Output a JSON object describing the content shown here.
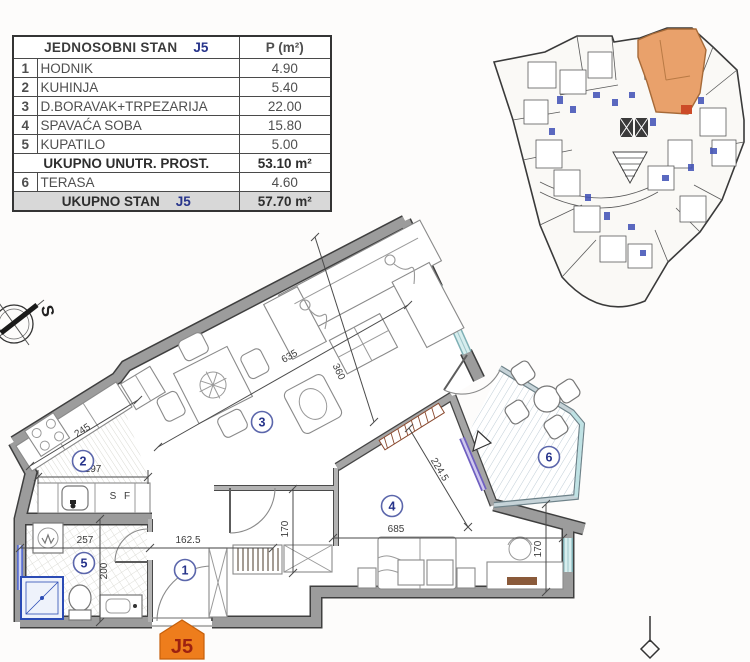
{
  "table": {
    "title": "JEDNOSOBNI STAN",
    "unit_code": "J5",
    "area_header": "P (m²)",
    "rows": [
      {
        "num": "1",
        "name": "HODNIK",
        "area": "4.90"
      },
      {
        "num": "2",
        "name": "KUHINJA",
        "area": "5.40"
      },
      {
        "num": "3",
        "name": "D.BORAVAK+TRPEZARIJA",
        "area": "22.00"
      },
      {
        "num": "4",
        "name": "SPAVAĆA SOBA",
        "area": "15.80"
      },
      {
        "num": "5",
        "name": "KUPATILO",
        "area": "5.00"
      }
    ],
    "subtotal": {
      "label": "UKUPNO UNUTR. PROST.",
      "value": "53.10",
      "unit": "m²"
    },
    "terrace_row": {
      "num": "6",
      "name": "TERASA",
      "area": "4.60"
    },
    "total": {
      "label": "UKUPNO STAN",
      "code": "J5",
      "value": "57.70",
      "unit": "m²"
    }
  },
  "plan": {
    "rooms": {
      "r1": "1",
      "r2": "2",
      "r3": "3",
      "r4": "4",
      "r5": "5",
      "r6": "6"
    },
    "dims": {
      "kitchen_counter": "245",
      "kitchen_width": "197",
      "living_length": "635",
      "living_width": "360",
      "bedroom_length": "685",
      "terrace_diag": "224.5",
      "hall_width": "162.5",
      "bath_width": "257",
      "bath_depth": "200",
      "hall_depth": "170",
      "bedroom_depth": "170"
    },
    "counter_s": "S",
    "counter_f": "F",
    "compass_label": "S",
    "unit_badge": "J5"
  },
  "colors": {
    "accent_blue": "#27348b",
    "badge_orange": "#ee7d1c",
    "badge_text": "#9c2110",
    "wall_gray": "#9c9c9c",
    "window_teal": "#cfe9ea",
    "keyplan_highlight": "#e9a16b",
    "marker_blue": "#3d4fb5",
    "total_row_bg": "#d8d8d8"
  }
}
